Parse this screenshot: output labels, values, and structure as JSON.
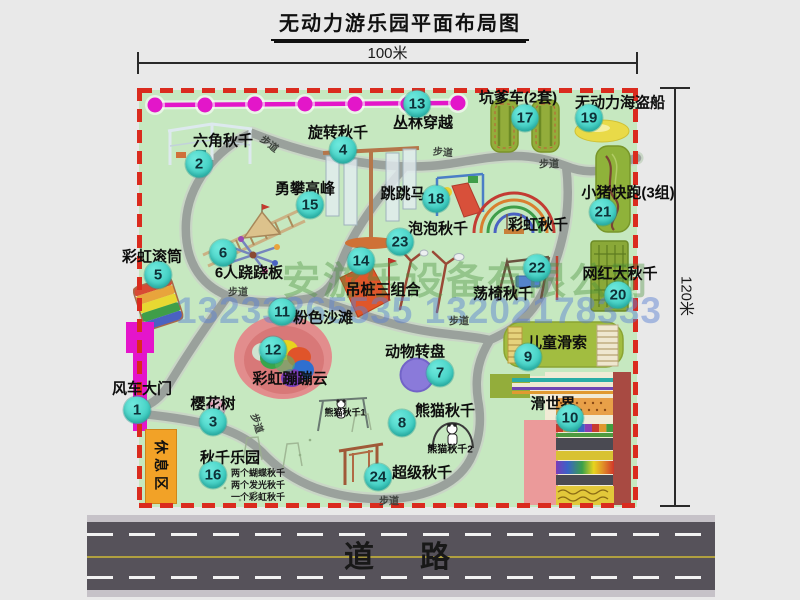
{
  "title": "无动力游乐园平面布局图",
  "dimensions": {
    "width": "100米",
    "height": "120米"
  },
  "road_label": "道　路",
  "watermark": {
    "company": "安游乐设备有限公司",
    "phone": "13233865535 13202178333"
  },
  "labels": {
    "rest_area": "休息区",
    "walkway": "步道",
    "rainbow_swing": "彩虹秋千",
    "panda_swing_1": "熊猫秋千1",
    "panda_swing_2": "熊猫秋千2"
  },
  "swing_park_notes": [
    "两个蝴蝶秋千",
    "两个发光秋千",
    "一个彩虹秋千"
  ],
  "attractions": [
    {
      "id": 1,
      "name": "风车大门"
    },
    {
      "id": 2,
      "name": "六角秋千"
    },
    {
      "id": 3,
      "name": "樱花树"
    },
    {
      "id": 4,
      "name": "旋转秋千"
    },
    {
      "id": 5,
      "name": "彩虹滚筒"
    },
    {
      "id": 6,
      "name": "6人跷跷板"
    },
    {
      "id": 7,
      "name": "动物转盘"
    },
    {
      "id": 8,
      "name": "熊猫秋千"
    },
    {
      "id": 9,
      "name": "儿童滑索"
    },
    {
      "id": 10,
      "name": "滑世界"
    },
    {
      "id": 11,
      "name": "粉色沙滩"
    },
    {
      "id": 12,
      "name": "彩虹蹦蹦云"
    },
    {
      "id": 13,
      "name": "丛林穿越"
    },
    {
      "id": 14,
      "name": "吊桩三组合"
    },
    {
      "id": 15,
      "name": "勇攀高峰"
    },
    {
      "id": 16,
      "name": "秋千乐园"
    },
    {
      "id": 17,
      "name": "坑爹车(2套)"
    },
    {
      "id": 18,
      "name": "跳跳马"
    },
    {
      "id": 19,
      "name": "无动力海盗船"
    },
    {
      "id": 20,
      "name": "网红大秋千"
    },
    {
      "id": 21,
      "name": "小猪快跑(3组)"
    },
    {
      "id": 22,
      "name": "荡椅秋千"
    },
    {
      "id": 23,
      "name": "泡泡秋千"
    },
    {
      "id": 24,
      "name": "超级秋千"
    }
  ],
  "colors": {
    "map_green": "#c6e8c0",
    "border_red": "#da2b1e",
    "badge_teal": "#2cc4b8",
    "path_gray": "#9aa19c",
    "chain_magenta": "#e316c9",
    "rest_orange": "#f2a227",
    "road_gray": "#56525a"
  }
}
